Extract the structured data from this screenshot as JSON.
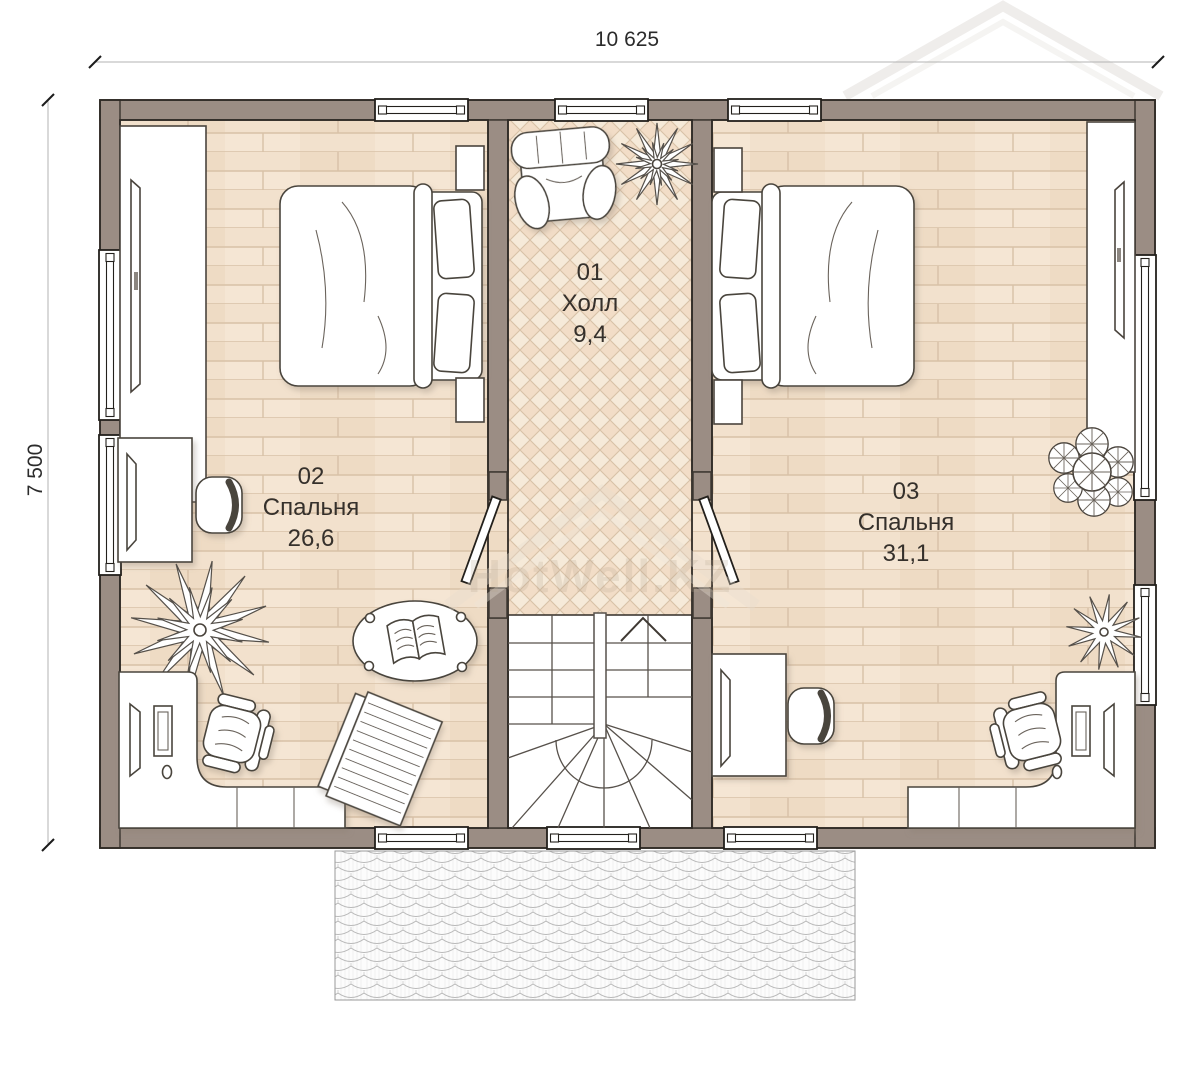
{
  "dimensions": {
    "width_label": "10 625",
    "height_label": "7 500"
  },
  "rooms": [
    {
      "number": "01",
      "name": "Холл",
      "area": "9,4"
    },
    {
      "number": "02",
      "name": "Спальня",
      "area": "26,6"
    },
    {
      "number": "03",
      "name": "Спальня",
      "area": "31,1"
    }
  ],
  "watermark": {
    "text": "HotWell.KZ"
  },
  "colors": {
    "wall": "#9b8d84",
    "floor_bedroom": "#f2e1cd",
    "floor_hall": "#f6ead9",
    "outline": "#2f2a25",
    "furniture_stroke": "#4a443d"
  }
}
